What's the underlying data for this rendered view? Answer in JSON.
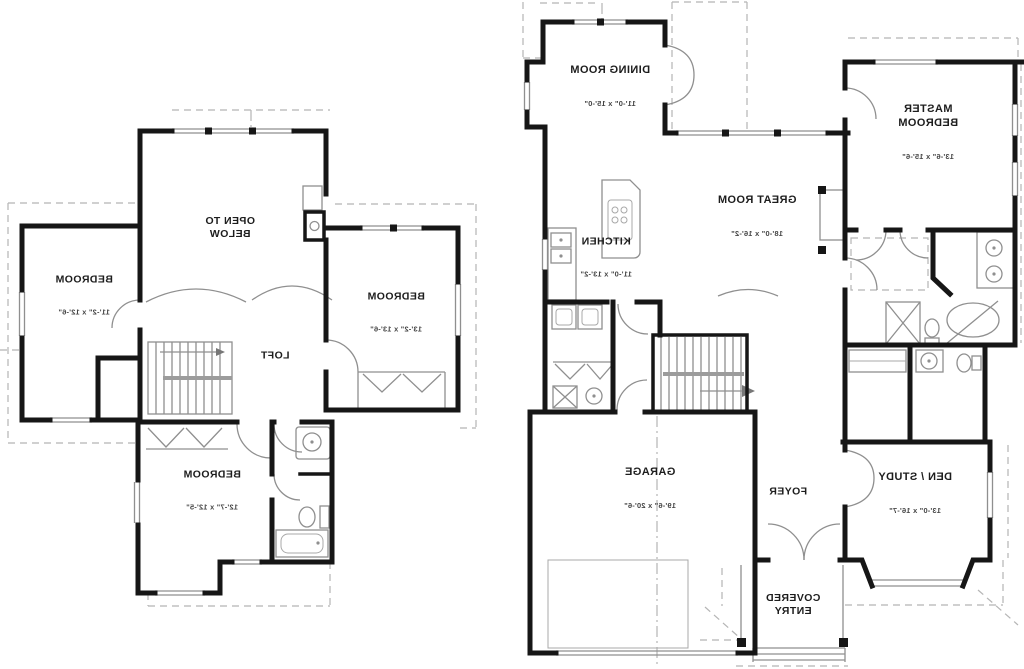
{
  "upper_floor": {
    "open_to_below": {
      "label": "OPEN TO\nBELOW"
    },
    "bedroom_left": {
      "label": "BEDROOM",
      "dims": "11'-2\" x 12'-6\""
    },
    "bedroom_right": {
      "label": "BEDROOM",
      "dims": "13'-2\" x 13'-6\""
    },
    "bedroom_rear": {
      "label": "BEDROOM",
      "dims": "12'-7\" x 12'-5\""
    },
    "loft": {
      "label": "LOFT"
    }
  },
  "main_floor": {
    "dining_room": {
      "label": "DINING ROOM",
      "dims": "11'-0\" x 15'-0\""
    },
    "kitchen": {
      "label": "KITCHEN",
      "dims": "11'-0\" x 13'-2\""
    },
    "great_room": {
      "label": "GREAT ROOM",
      "dims": "18'-0\" x 16'-2\""
    },
    "master_bedroom": {
      "label": "MASTER\nBEDROOM",
      "dims": "13'-6\" x 15'-6\""
    },
    "garage": {
      "label": "GARAGE",
      "dims": "19'-6\" x 20'-6\""
    },
    "foyer": {
      "label": "FOYER"
    },
    "den_study": {
      "label": "DEN / STUDY",
      "dims": "13'-0\" x 16'-7\""
    },
    "covered_entry": {
      "label": "COVERED\nENTRY"
    }
  },
  "colors": {
    "wall": "#161616",
    "thin_line": "#8f8f8f",
    "dashed_line": "#b5b5b5",
    "background": "#ffffff"
  }
}
